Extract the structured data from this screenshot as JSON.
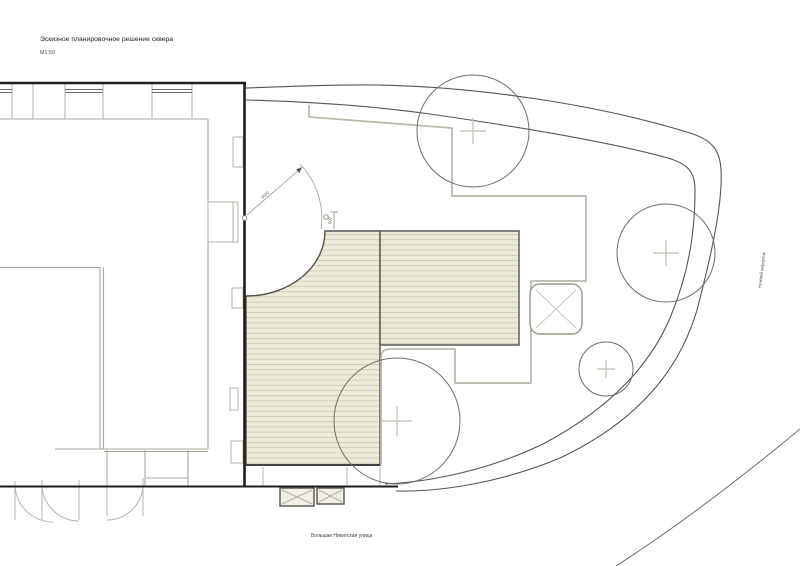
{
  "page": {
    "title": "Эскизное планировочное решение сквера",
    "scale_label": "М1:50"
  },
  "streets": {
    "bottom": "Большая Никитская улица",
    "right": "Нижний переулок"
  },
  "dimensions": {
    "door_swing_radius": "3000",
    "deck_edge_offset": "500"
  },
  "legend_semantics": {
    "deck": "wooden decking terrace",
    "hatched_squares": "planters / tree pits",
    "circles_with_cross": "existing trees",
    "thick_lines": "building walls",
    "thin_double_curve": "site boundary along street"
  },
  "colors": {
    "background": "#ffffff",
    "deck_fill": "#ecebdb",
    "deck_board_line": "#cfcbb0",
    "deck_border": "#55534d",
    "wall": "#1e1e1c",
    "interior_line": "#a9a79b",
    "bay_line": "#b3b1a4",
    "path_line": "#bab8ac",
    "tree_stroke": "#6f6e68",
    "tree_cross": "#c9c7ba",
    "boundary": "#56554f"
  },
  "trees": [
    {
      "id": "tree-1",
      "cx": 473,
      "cy": 131,
      "r": 56,
      "cross": 13
    },
    {
      "id": "tree-2",
      "cx": 666,
      "cy": 253,
      "r": 49,
      "cross": 13
    },
    {
      "id": "tree-3",
      "cx": 606,
      "cy": 369,
      "r": 27,
      "cross": 9
    },
    {
      "id": "tree-4",
      "cx": 397,
      "cy": 421,
      "r": 63,
      "cross": 15
    }
  ]
}
